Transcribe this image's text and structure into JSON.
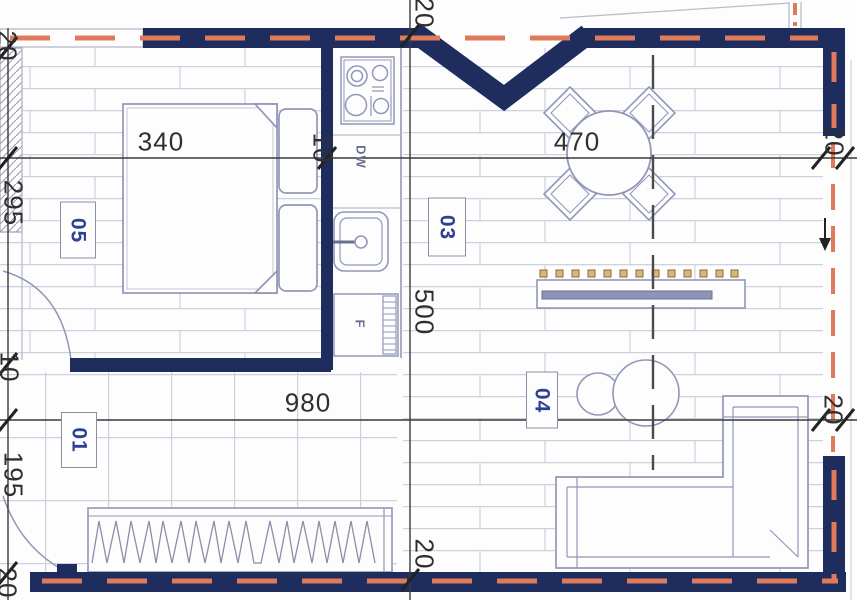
{
  "colors": {
    "wall": "#1e2c5e",
    "insulation": "#df7a5a",
    "furniture-line": "#9297b8",
    "floor-line": "#ccd0df",
    "dim-line": "#3a3a3a",
    "room-label": "#2e4191",
    "knob": "#d9b87c",
    "bg": "#fdfdfe"
  },
  "rooms": {
    "r05": "05",
    "r03": "03",
    "r01": "01",
    "r04": "04"
  },
  "dims": {
    "d340": "340",
    "d10_top": "10",
    "d470": "470",
    "d20_top_right": "20",
    "d20_top_center": "20",
    "d500": "500",
    "d20_bottom_center": "20",
    "d980": "980",
    "d20_mid_right": "20",
    "d20_top_left": "20",
    "d295": "295",
    "d10_left": "10",
    "d195": "195",
    "d20_bottom_left": "20"
  },
  "labels": {
    "dishwasher": "DW",
    "fridge": "F"
  }
}
